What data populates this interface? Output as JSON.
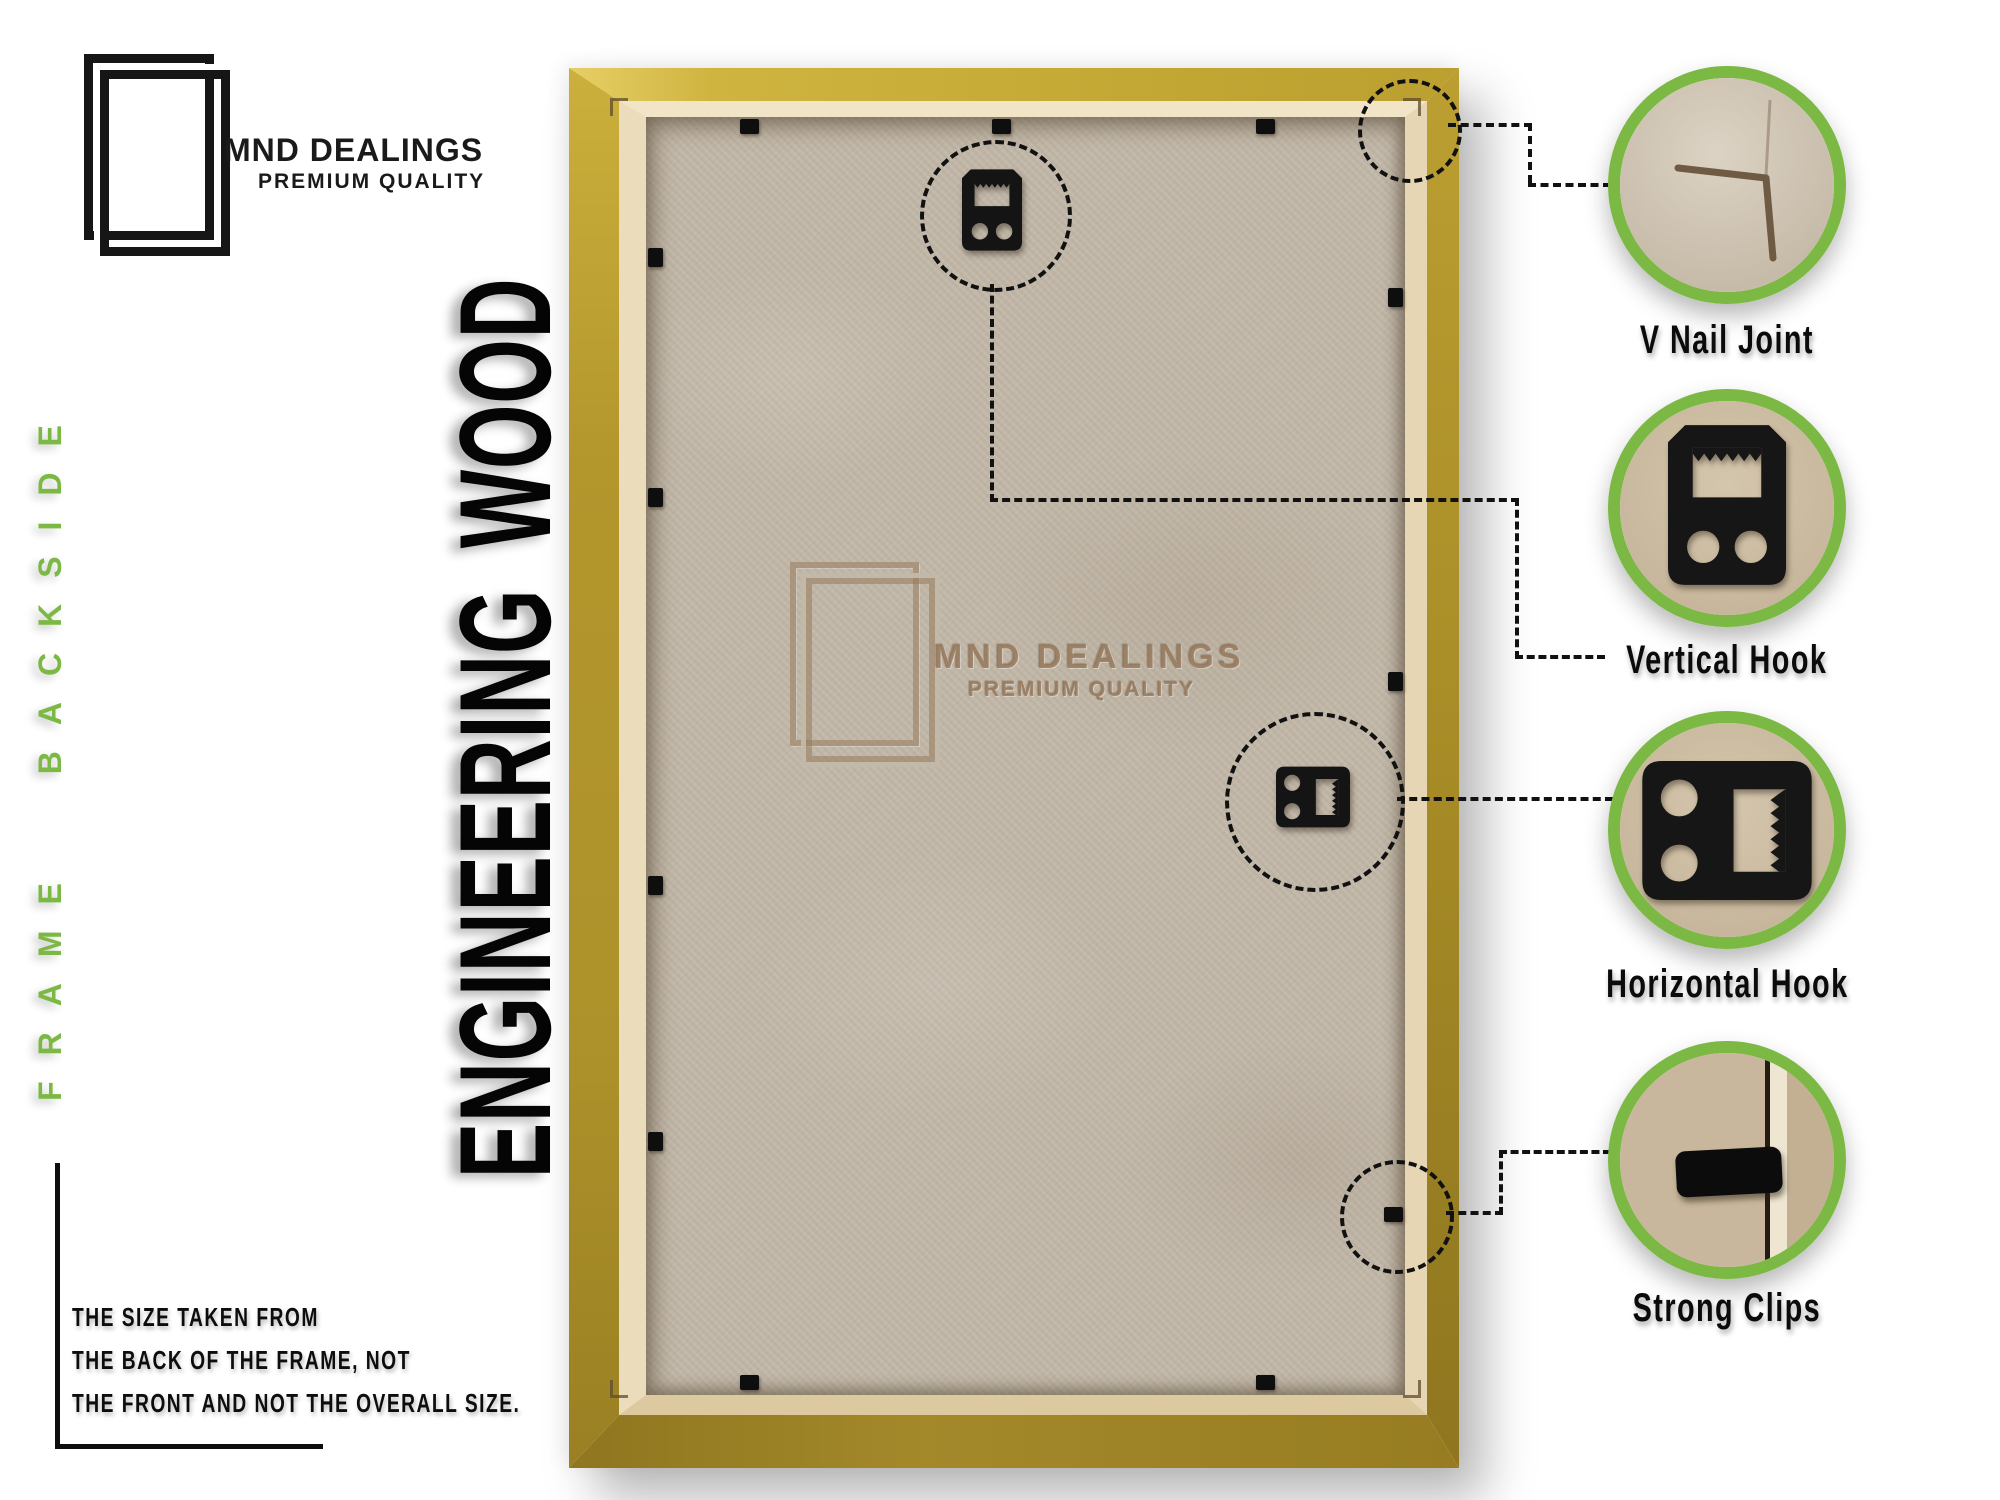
{
  "brand": {
    "name": "MND DEALINGS",
    "tagline": "PREMIUM QUALITY"
  },
  "side_text": {
    "left_green": "FRAME BACKSIDE",
    "material": "ENGINEERING WOOD"
  },
  "watermark": {
    "name": "MND DEALINGS",
    "tagline": "PREMIUM QUALITY"
  },
  "callouts": [
    {
      "id": "v-nail-joint",
      "label": "V Nail Joint"
    },
    {
      "id": "vertical-hook",
      "label": "Vertical Hook"
    },
    {
      "id": "horizontal-hook",
      "label": "Horizontal Hook"
    },
    {
      "id": "strong-clips",
      "label": "Strong Clips"
    }
  ],
  "note": {
    "line1": "THE SIZE TAKEN FROM",
    "line2": "THE BACK OF THE FRAME, NOT",
    "line3": "THE FRONT AND NOT THE OVERALL SIZE."
  },
  "icons": {
    "brand_logo": "double-picture-frame-icon",
    "vertical_hook": "vertical-hook-icon",
    "horizontal_hook": "horizontal-hook-icon",
    "strong_clip": "strong-clip-icon",
    "v_nail_joint": "v-nail-corner-icon"
  },
  "colors": {
    "accent_green": "#7cb944",
    "frame_gold": "#b2962c",
    "frame_gold_light": "#d3b845",
    "frame_gold_dark": "#977c21",
    "lip_cream": "#e9dabb",
    "board_tan": "#c2b8a9",
    "hardware_black": "#141414",
    "text_black": "#111111"
  }
}
